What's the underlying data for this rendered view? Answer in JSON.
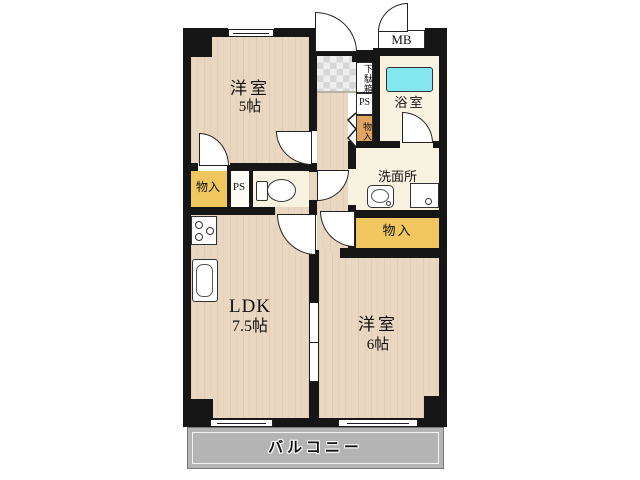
{
  "rooms": {
    "bedroom5": {
      "name": "洋室",
      "size": "5帖"
    },
    "ldk": {
      "name": "LDK",
      "size": "7.5帖"
    },
    "bedroom6": {
      "name": "洋室",
      "size": "6帖"
    },
    "bathroom": {
      "label": "浴室"
    },
    "washroom": {
      "label": "洗面所"
    }
  },
  "closets": {
    "entrance_shoe": "下駄箱",
    "entrance_ps": "PS",
    "entrance_storage": "物入",
    "hall_storage": "物入",
    "hall_ps": "PS",
    "side_storage": "物入"
  },
  "meter_box": "MB",
  "balcony": "バルコニー",
  "colors": {
    "wall": "#161616",
    "wood_floor": "#ead7c1",
    "ivory_floor": "#f8f3e1",
    "storage_yellow": "#f0c75f",
    "storage_orange": "#e0a55f",
    "bathtub_cyan": "#84e6ee",
    "balcony_gray": "#b4b4b4",
    "entrance_tile": "#d9d9d9"
  }
}
